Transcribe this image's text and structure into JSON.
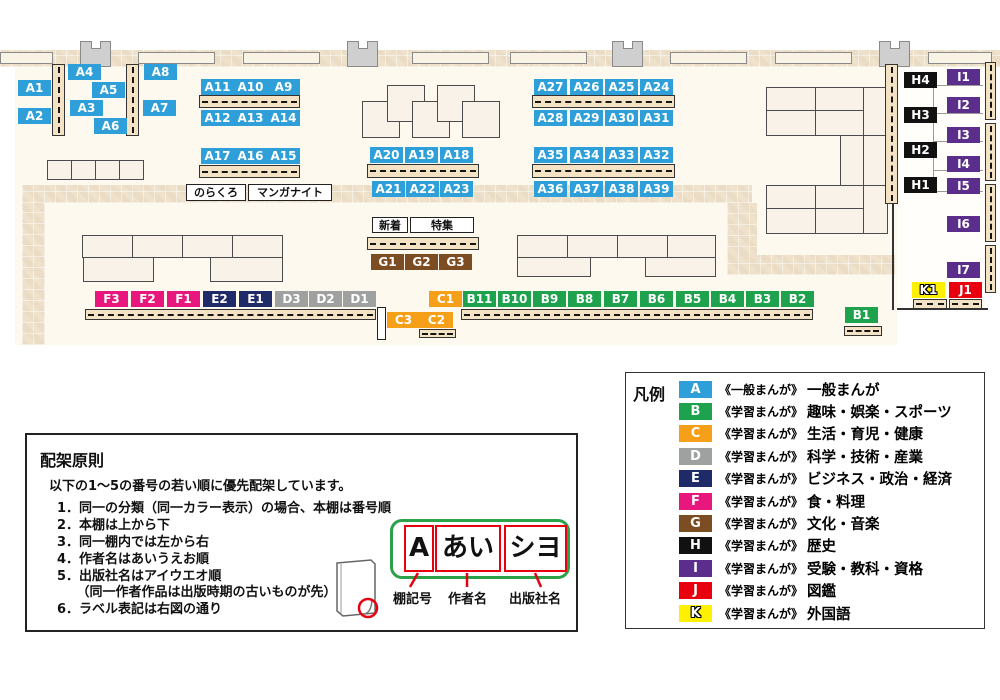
{
  "colors": {
    "A": "#2E9FD8",
    "B": "#1FA24E",
    "C": "#F5A018",
    "D": "#9FA0A0",
    "E": "#1F2A69",
    "F": "#E8177E",
    "G": "#7C4C23",
    "H": "#111111",
    "I": "#5C2E8C",
    "J": "#E8000F",
    "K": "#FFF000"
  },
  "map": {
    "labels": {
      "A1": "A1",
      "A2": "A2",
      "A3": "A3",
      "A4": "A4",
      "A5": "A5",
      "A6": "A6",
      "A7": "A7",
      "A8": "A8",
      "A9": "A9",
      "A10": "A10",
      "A11": "A11",
      "A12": "A12",
      "A13": "A13",
      "A14": "A14",
      "A15": "A15",
      "A16": "A16",
      "A17": "A17",
      "A18": "A18",
      "A19": "A19",
      "A20": "A20",
      "A21": "A21",
      "A22": "A22",
      "A23": "A23",
      "A24": "A24",
      "A25": "A25",
      "A26": "A26",
      "A27": "A27",
      "A28": "A28",
      "A29": "A29",
      "A30": "A30",
      "A31": "A31",
      "A32": "A32",
      "A33": "A33",
      "A34": "A34",
      "A35": "A35",
      "A36": "A36",
      "A37": "A37",
      "A38": "A38",
      "A39": "A39",
      "B1": "B1",
      "B2": "B2",
      "B3": "B3",
      "B4": "B4",
      "B5": "B5",
      "B6": "B6",
      "B7": "B7",
      "B8": "B8",
      "B9": "B9",
      "B10": "B10",
      "B11": "B11",
      "C1": "C1",
      "C2": "C2",
      "C3": "C3",
      "D1": "D1",
      "D2": "D2",
      "D3": "D3",
      "E1": "E1",
      "E2": "E2",
      "F1": "F1",
      "F2": "F2",
      "F3": "F3",
      "G1": "G1",
      "G2": "G2",
      "G3": "G3",
      "H1": "H1",
      "H2": "H2",
      "H3": "H3",
      "H4": "H4",
      "I1": "I1",
      "I2": "I2",
      "I3": "I3",
      "I4": "I4",
      "I5": "I5",
      "I6": "I6",
      "I7": "I7",
      "J1": "J1",
      "K1": "K1"
    },
    "annotations": {
      "norakuro": "のらくろ",
      "manganight": "マンガナイト",
      "shinchaku": "新着",
      "tokushu": "特集"
    }
  },
  "principles": {
    "title": "配架原則",
    "intro": "以下の1～5の番号の若い順に優先配架しています。",
    "items": [
      "1．同一の分類（同一カラー表示）の場合、本棚は番号順",
      "2．本棚は上から下",
      "3．同一棚内では左から右",
      "4．作者名はあいうえお順",
      "5．出版社名はアイウエオ順",
      "　　（同一作者作品は出版時期の古いものが先）",
      "6．ラベル表記は右図の通り"
    ],
    "diagram": {
      "shelf_code": "A",
      "author": "あい",
      "publisher": "シヨ",
      "label_shelf": "棚記号",
      "label_author": "作者名",
      "label_publisher": "出版社名"
    }
  },
  "legend": {
    "title": "凡例",
    "rows": [
      {
        "letter": "A",
        "tag": "《一般まんが》",
        "category": "一般まんが"
      },
      {
        "letter": "B",
        "tag": "《学習まんが》",
        "category": "趣味・娯楽・スポーツ"
      },
      {
        "letter": "C",
        "tag": "《学習まんが》",
        "category": "生活・育児・健康"
      },
      {
        "letter": "D",
        "tag": "《学習まんが》",
        "category": "科学・技術・産業"
      },
      {
        "letter": "E",
        "tag": "《学習まんが》",
        "category": "ビジネス・政治・経済"
      },
      {
        "letter": "F",
        "tag": "《学習まんが》",
        "category": "食・料理"
      },
      {
        "letter": "G",
        "tag": "《学習まんが》",
        "category": "文化・音楽"
      },
      {
        "letter": "H",
        "tag": "《学習まんが》",
        "category": "歴史"
      },
      {
        "letter": "I",
        "tag": "《学習まんが》",
        "category": "受験・教科・資格"
      },
      {
        "letter": "J",
        "tag": "《学習まんが》",
        "category": "図鑑"
      },
      {
        "letter": "K",
        "tag": "《学習まんが》",
        "category": "外国語"
      }
    ]
  }
}
